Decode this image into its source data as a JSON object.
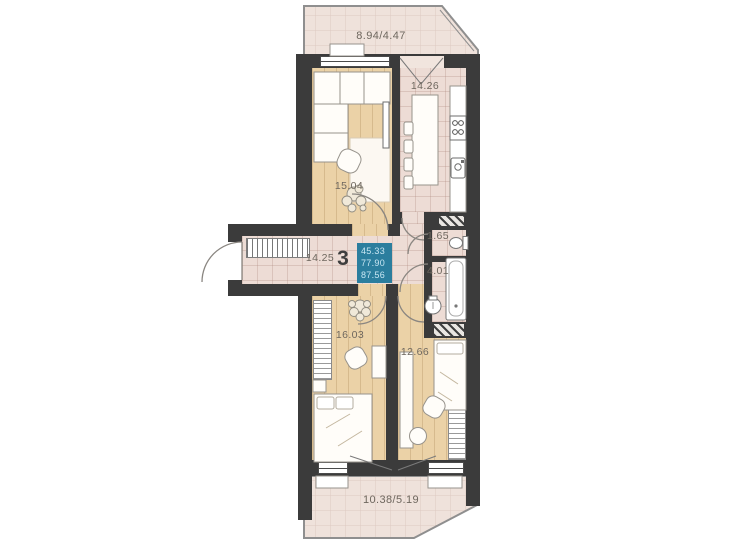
{
  "floorplan": {
    "unit_number": "3",
    "area_summary": {
      "line1": "45.33",
      "line2": "77.90",
      "line3": "87.56"
    },
    "labels": {
      "balcony_top": "8.94/4.47",
      "kitchen": "14.26",
      "living_room": "15.04",
      "hallway": "14.25",
      "wc": "1.65",
      "bathroom": "4.01",
      "bedroom_main": "16.03",
      "bedroom_second": "12.66",
      "balcony_bottom": "10.38/5.19"
    },
    "colors": {
      "wall": "#3b3b3b",
      "wood_floor": "#ebd2a7",
      "tile_floor": "#eddcd5",
      "balcony_floor": "#efe2db",
      "accent_box": "#2b7e9e",
      "accent_box_text": "#c9e7f3",
      "label_text": "#6e675e"
    }
  }
}
